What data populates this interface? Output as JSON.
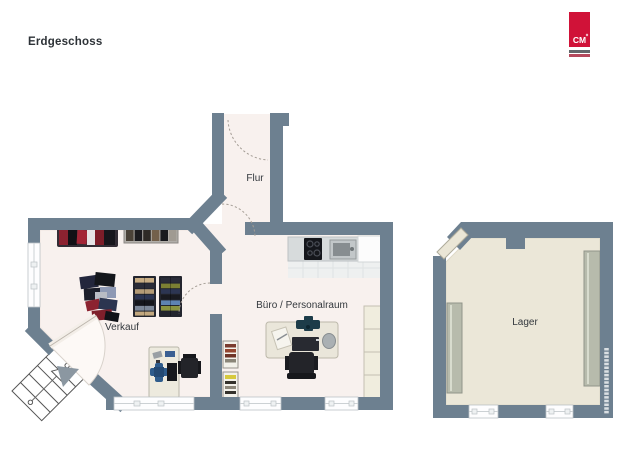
{
  "header": {
    "title": "Erdgeschoss"
  },
  "logo": {
    "text": "CM",
    "brand_color": "#d01238"
  },
  "floorplan": {
    "floor_name": "Erdgeschoss",
    "rooms": [
      {
        "name": "flur",
        "label": "Flur"
      },
      {
        "name": "verkauf",
        "label": "Verkauf"
      },
      {
        "name": "buero",
        "label": "Büro / Personalraum"
      },
      {
        "name": "lager",
        "label": "Lager"
      }
    ],
    "features": [
      "entrance-door-with-exterior-staircase",
      "kitchen-counter-with-cooktop-and-sink",
      "clothing-racks-in-verkauf",
      "desks-with-office-chairs",
      "storage-shelves-in-lager"
    ],
    "colors": {
      "wall": "#6d8090",
      "floor_main": "#f8f1ee",
      "floor_lager": "#ebe7d8",
      "window": "#fdfdfe",
      "accent_red": "#d01238"
    }
  }
}
